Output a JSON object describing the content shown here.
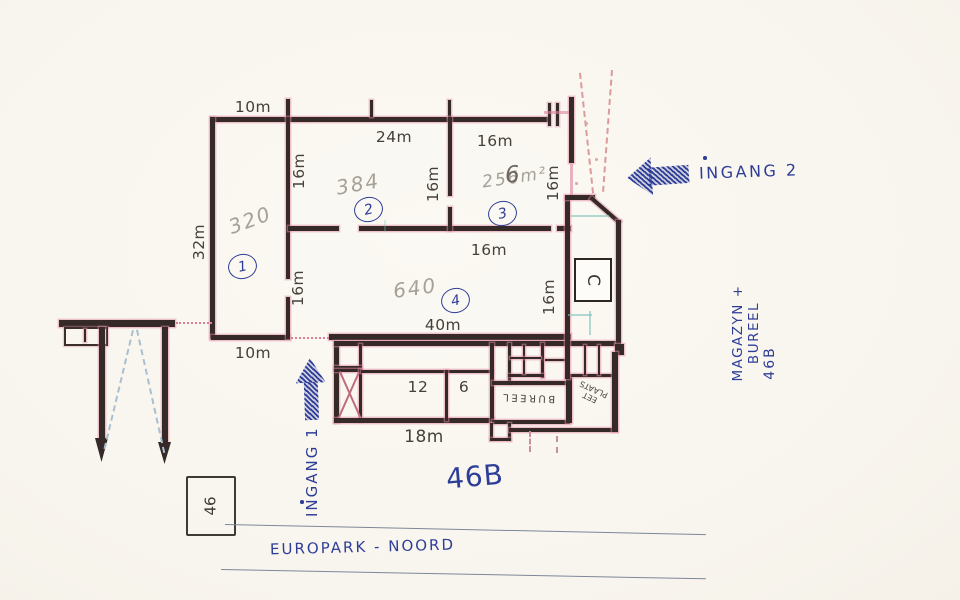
{
  "dims": {
    "m10": "10m",
    "m24": "24m",
    "m16": "16m",
    "m32": "32m",
    "m40": "40m",
    "m18": "18m",
    "room12": "12",
    "room6": "6"
  },
  "pencil": {
    "room1_area": "320",
    "room2_area": "384",
    "room3_area": "256m²",
    "room3_digit": "6",
    "room4_area": "640"
  },
  "room_numbers": {
    "r1": "1",
    "r2": "2",
    "r3": "3",
    "r4": "4"
  },
  "room_labels": {
    "c": "C",
    "bureel": "BUREEL",
    "eet_line1": "EET",
    "eet_line2": "PLAATS"
  },
  "ink_notes": {
    "ingang1": "INGANG 1",
    "ingang2": "INGANG 2",
    "magazyn": "MAGAZYN + BUREEL",
    "magazyn_no": "46B",
    "site_no": "46B",
    "street": "EUROPARK - NOORD",
    "parcel": "46"
  },
  "colors": {
    "ink_blue": "#2e3d97",
    "pencil_grey": "#a6a096",
    "wall_dark": "#352a28",
    "marker_pink": "#e08aa2",
    "print_grey": "#46403a",
    "dash_red": "#db9595",
    "cyan": "#8fccc6",
    "paper": "#faf8f2"
  }
}
